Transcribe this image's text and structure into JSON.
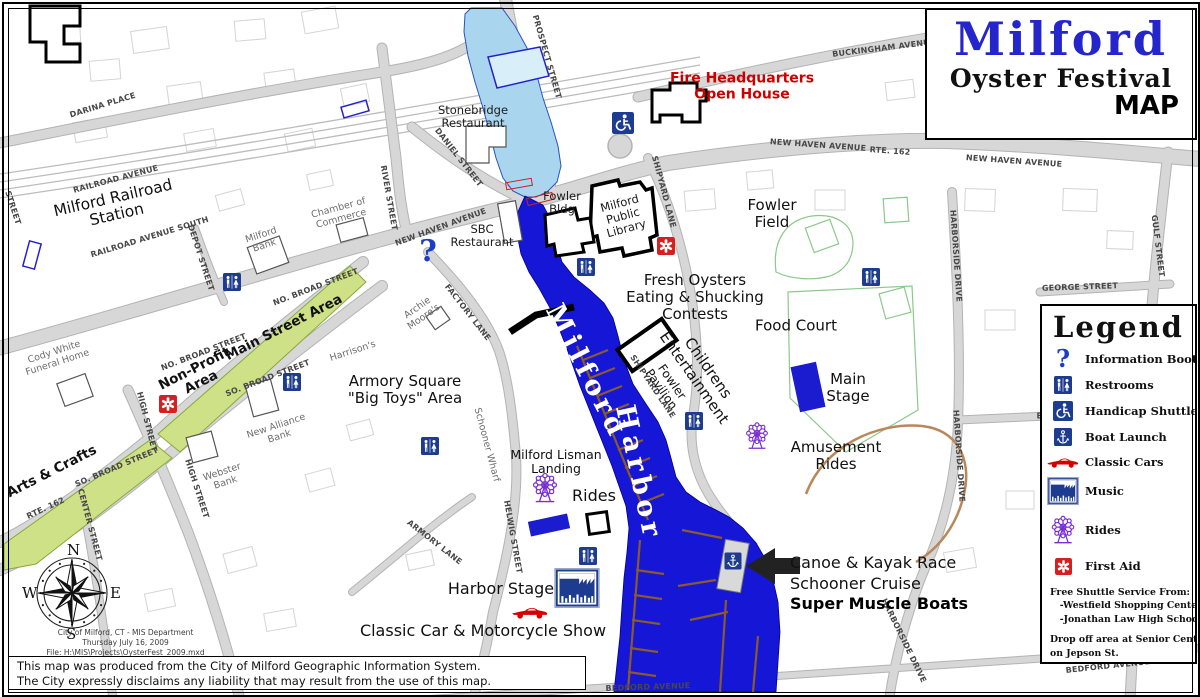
{
  "title_box": {
    "title": "Milford",
    "subtitle": "Oyster Festival",
    "map_word": "MAP"
  },
  "legend": {
    "title": "Legend",
    "items": [
      {
        "icon": "info",
        "label": "Information Booth"
      },
      {
        "icon": "restroom",
        "label": "Restrooms"
      },
      {
        "icon": "handicap",
        "label": "Handicap Shuttle"
      },
      {
        "icon": "anchor",
        "label": "Boat Launch"
      },
      {
        "icon": "car",
        "label": "Classic Cars"
      },
      {
        "icon": "music",
        "label": "Music"
      },
      {
        "icon": "ferris",
        "label": "Rides"
      },
      {
        "icon": "firstaid",
        "label": "First Aid"
      }
    ],
    "notes": [
      "Free Shuttle Service From:",
      "   -Westfield Shopping Center",
      "   -Jonathan Law High School",
      "",
      "Drop off area at Senior Center",
      "on Jepson St.",
      "Police - 1st Floor Fowler Building"
    ]
  },
  "compass": {
    "n": "N",
    "e": "E",
    "s": "S",
    "w": "W"
  },
  "credits": {
    "lines": [
      "City of Milford, CT - MIS Department",
      "Thursday July 16, 2009",
      "File: H:\\MIS\\Projects\\OysterFest_2009.mxd"
    ]
  },
  "disclaimer": {
    "lines": [
      "This map was produced from the City of Milford Geographic Information System.",
      "The City expressly disclaims any liability that may result from the use of this map."
    ]
  },
  "colors": {
    "title_blue": "#2525cc",
    "harbor_blue": "#1616d6",
    "river_blue": "#a9d6ee",
    "festival_green": "#cfe187",
    "icon_blue": "#1d3c8f",
    "first_aid_red": "#d42020",
    "rides_purple": "#7a2fd0",
    "classic_car_red": "#d40000",
    "fire_red": "#cc0000"
  },
  "map": {
    "labels": [
      {
        "t": "DARINA PLACE",
        "x": 103,
        "y": 106,
        "r": -17,
        "c": "st"
      },
      {
        "t": "PROSPECT STREET",
        "x": 546,
        "y": 57,
        "r": 74,
        "c": "st"
      },
      {
        "t": "RAILROAD AVENUE",
        "x": 116,
        "y": 180,
        "r": -15,
        "c": "st"
      },
      {
        "t": "RAILROAD AVENUE SOUTH",
        "x": 150,
        "y": 238,
        "r": -17,
        "c": "st"
      },
      {
        "t": "DEPOT STREET",
        "x": 200,
        "y": 258,
        "r": 72,
        "c": "st"
      },
      {
        "t": "RIVER STREET",
        "x": 388,
        "y": 198,
        "r": 80,
        "c": "st"
      },
      {
        "t": "STREET",
        "x": 12,
        "y": 208,
        "r": 72,
        "c": "st"
      },
      {
        "t": "DANIEL STREET",
        "x": 458,
        "y": 158,
        "r": 52,
        "c": "st"
      },
      {
        "t": "NEW HAVEN AVENUE",
        "x": 441,
        "y": 228,
        "r": -20,
        "c": "st"
      },
      {
        "t": "NEW HAVEN AVENUE",
        "x": 818,
        "y": 146,
        "r": 4,
        "c": "st"
      },
      {
        "t": "RTE. 162",
        "x": 890,
        "y": 152,
        "r": 4,
        "c": "st"
      },
      {
        "t": "NEW HAVEN AVENUE",
        "x": 1014,
        "y": 162,
        "r": 4,
        "c": "st"
      },
      {
        "t": "BUCKINGHAM AVENUE",
        "x": 884,
        "y": 49,
        "r": -7,
        "c": "st"
      },
      {
        "t": "SHIPYARD LANE",
        "x": 663,
        "y": 192,
        "r": 75,
        "c": "st"
      },
      {
        "t": "SHIPYARD LANE",
        "x": 652,
        "y": 387,
        "r": 56,
        "c": "st"
      },
      {
        "t": "NO. BROAD STREET",
        "x": 316,
        "y": 288,
        "r": -21,
        "c": "st"
      },
      {
        "t": "NO. BROAD STREET",
        "x": 204,
        "y": 353,
        "r": -21,
        "c": "st"
      },
      {
        "t": "SO. BROAD STREET",
        "x": 268,
        "y": 379,
        "r": -21,
        "c": "st"
      },
      {
        "t": "SO. BROAD STREET",
        "x": 117,
        "y": 468,
        "r": -23,
        "c": "st"
      },
      {
        "t": "HIGH STREET",
        "x": 146,
        "y": 422,
        "r": 76,
        "c": "st"
      },
      {
        "t": "HIGH STREET",
        "x": 196,
        "y": 489,
        "r": 72,
        "c": "st"
      },
      {
        "t": "RTE. 162",
        "x": 46,
        "y": 509,
        "r": -25,
        "c": "st"
      },
      {
        "t": "CENTER STREET",
        "x": 89,
        "y": 525,
        "r": 75,
        "c": "st"
      },
      {
        "t": "FACTORY LANE",
        "x": 467,
        "y": 313,
        "r": 52,
        "c": "st"
      },
      {
        "t": "ARMORY LANE",
        "x": 434,
        "y": 543,
        "r": 38,
        "c": "st"
      },
      {
        "t": "HELWIG STREET",
        "x": 512,
        "y": 537,
        "r": 80,
        "c": "st"
      },
      {
        "t": "GEORGE STREET",
        "x": 1080,
        "y": 288,
        "r": -2,
        "c": "st"
      },
      {
        "t": "GULF STREET",
        "x": 1157,
        "y": 246,
        "r": 83,
        "c": "st"
      },
      {
        "t": "HARBORSIDE DRIVE",
        "x": 955,
        "y": 256,
        "r": 86,
        "c": "st"
      },
      {
        "t": "HARBORSIDE DRIVE",
        "x": 958,
        "y": 456,
        "r": 86,
        "c": "st"
      },
      {
        "t": "HARBORSIDE DRIVE",
        "x": 903,
        "y": 641,
        "r": 64,
        "c": "st"
      },
      {
        "t": "EL",
        "x": 1042,
        "y": 417,
        "r": 0,
        "c": "st"
      },
      {
        "t": "BEDFORD AVENUE",
        "x": 648,
        "y": 688,
        "r": -2,
        "c": "st"
      },
      {
        "t": "BEDFORD AVENUE",
        "x": 1108,
        "y": 667,
        "r": -6,
        "c": "st"
      },
      {
        "t": "Schooner Wharf",
        "x": 486,
        "y": 445,
        "r": 75,
        "c": "pl"
      },
      {
        "t": "Cody White\nFuneral Home",
        "x": 56,
        "y": 358,
        "r": -18,
        "c": "pl"
      },
      {
        "t": "Milford\nBank",
        "x": 263,
        "y": 241,
        "r": -18,
        "c": "pl"
      },
      {
        "t": "Chamber of\nCommerce",
        "x": 340,
        "y": 214,
        "r": -15,
        "c": "pl"
      },
      {
        "t": "Archie\nMoore's",
        "x": 421,
        "y": 313,
        "r": -35,
        "c": "pl"
      },
      {
        "t": "Harrison's",
        "x": 353,
        "y": 352,
        "r": -18,
        "c": "pl"
      },
      {
        "t": "New Alliance\nBank",
        "x": 278,
        "y": 432,
        "r": -18,
        "c": "pl"
      },
      {
        "t": "Webster\nBank",
        "x": 224,
        "y": 478,
        "r": -18,
        "c": "pl"
      },
      {
        "t": "Stonebridge\nRestaurant",
        "x": 473,
        "y": 117,
        "r": 0,
        "c": "pl2"
      },
      {
        "t": "SBC\nRestaurant",
        "x": 482,
        "y": 236,
        "r": 0,
        "c": "pl2"
      },
      {
        "t": "Fowler\nBldg",
        "x": 562,
        "y": 203,
        "r": 0,
        "c": "pl2"
      },
      {
        "t": "Milford\nPublic\nLibrary",
        "x": 623,
        "y": 216,
        "r": -15,
        "c": "pl2"
      },
      {
        "t": "Milford Railroad\nStation",
        "x": 115,
        "y": 207,
        "r": -13,
        "c": "big"
      },
      {
        "t": "Fowler\nField",
        "x": 772,
        "y": 214,
        "r": 0,
        "c": "ev"
      },
      {
        "t": "Fresh Oysters\nEating & Shucking\nContests",
        "x": 695,
        "y": 297,
        "r": 0,
        "c": "ev"
      },
      {
        "t": "Food Court",
        "x": 796,
        "y": 326,
        "r": 0,
        "c": "ev"
      },
      {
        "t": "Main\nStage",
        "x": 848,
        "y": 388,
        "r": 0,
        "c": "ev"
      },
      {
        "t": "Amusement\nRides",
        "x": 836,
        "y": 456,
        "r": 0,
        "c": "ev"
      },
      {
        "t": "Armory Square\n\"Big Toys\" Area",
        "x": 405,
        "y": 390,
        "r": 0,
        "c": "ev"
      },
      {
        "t": "Milford Lisman\nLanding",
        "x": 556,
        "y": 462,
        "r": 0,
        "c": "ev2"
      },
      {
        "t": "Rides",
        "x": 594,
        "y": 496,
        "r": 0,
        "c": "ev3"
      },
      {
        "t": "Harbor Stage",
        "x": 501,
        "y": 589,
        "r": 0,
        "c": "ev3"
      },
      {
        "t": "Classic Car & Motorcycle Show",
        "x": 483,
        "y": 631,
        "r": 0,
        "c": "ev3"
      },
      {
        "t": "Canoe & Kayak Race",
        "x": 790,
        "y": 563,
        "r": 0,
        "c": "ev3",
        "a": "l"
      },
      {
        "t": "Schooner Cruise",
        "x": 790,
        "y": 584,
        "r": 0,
        "c": "ev3",
        "a": "l"
      },
      {
        "t": "Super Muscle Boats",
        "x": 790,
        "y": 604,
        "r": 0,
        "c": "evb",
        "a": "l"
      },
      {
        "t": "Childrens\nEntertainment",
        "x": 701,
        "y": 373,
        "r": 55,
        "c": "evr"
      },
      {
        "t": "Fowler\nPavilion",
        "x": 666,
        "y": 386,
        "r": 55,
        "c": "evr2"
      },
      {
        "t": "Fire Headquarters\nOpen House",
        "x": 742,
        "y": 87,
        "r": 0,
        "c": "red"
      },
      {
        "t": "Main Street Area",
        "x": 284,
        "y": 328,
        "r": -27,
        "c": "grn"
      },
      {
        "t": "Non-Profit\nArea",
        "x": 198,
        "y": 376,
        "r": -27,
        "c": "grn"
      },
      {
        "t": "Arts & Crafts",
        "x": 52,
        "y": 472,
        "r": -27,
        "c": "grn"
      },
      {
        "t": "Milford",
        "x": 586,
        "y": 372,
        "r": 63,
        "c": "wat"
      },
      {
        "t": "Harbor",
        "x": 638,
        "y": 473,
        "r": 78,
        "c": "wat"
      }
    ],
    "icons": [
      {
        "k": "info",
        "x": 428,
        "y": 252,
        "s": 30
      },
      {
        "k": "restroom",
        "x": 232,
        "y": 282,
        "s": 18
      },
      {
        "k": "restroom",
        "x": 292,
        "y": 382,
        "s": 18
      },
      {
        "k": "restroom",
        "x": 430,
        "y": 446,
        "s": 18
      },
      {
        "k": "restroom",
        "x": 586,
        "y": 267,
        "s": 18
      },
      {
        "k": "restroom",
        "x": 694,
        "y": 421,
        "s": 18
      },
      {
        "k": "restroom",
        "x": 871,
        "y": 277,
        "s": 18
      },
      {
        "k": "restroom",
        "x": 588,
        "y": 556,
        "s": 18
      },
      {
        "k": "handicap",
        "x": 623,
        "y": 123,
        "s": 22
      },
      {
        "k": "firstaid",
        "x": 168,
        "y": 404,
        "s": 18
      },
      {
        "k": "firstaid",
        "x": 666,
        "y": 246,
        "s": 18
      },
      {
        "k": "ferris",
        "x": 545,
        "y": 488,
        "s": 30
      },
      {
        "k": "ferris",
        "x": 757,
        "y": 436,
        "s": 27
      },
      {
        "k": "music",
        "x": 577,
        "y": 588,
        "s": 46
      },
      {
        "k": "car",
        "x": 530,
        "y": 612,
        "s": 38
      },
      {
        "k": "anchor",
        "x": 733,
        "y": 561,
        "s": 17
      }
    ]
  }
}
